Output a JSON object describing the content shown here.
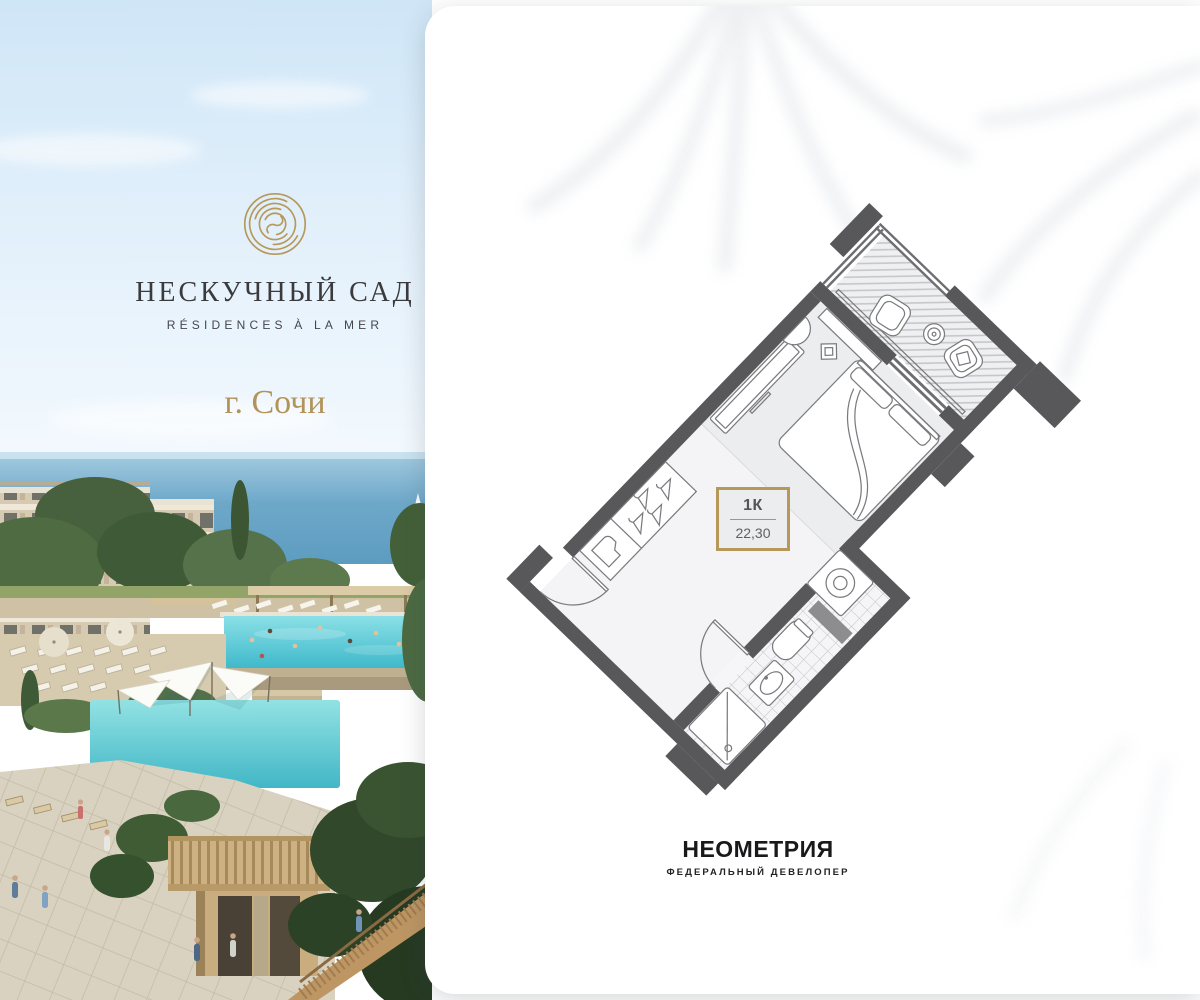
{
  "brand": {
    "title": "НЕСКУЧНЫЙ САД",
    "subtitle": "RÉSIDENCES À LA MER",
    "city": "г. Сочи",
    "icon": "spiral-monogram-icon",
    "gold_color": "#b6985a"
  },
  "plan": {
    "unit_type": "1К",
    "area": "22,30",
    "accent_color": "#b5985a",
    "wall_color": "#58585b"
  },
  "developer": {
    "name": "НЕОМЕТРИЯ",
    "tagline": "ФЕДЕРАЛЬНЫЙ ДЕВЕЛОПЕР"
  }
}
